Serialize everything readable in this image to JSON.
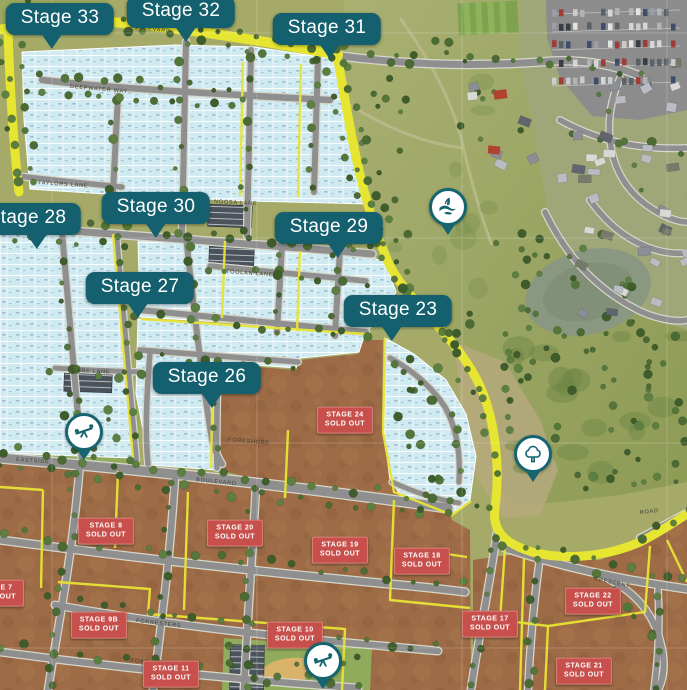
{
  "map": {
    "callouts": [
      {
        "label": "Stage 33"
      },
      {
        "label": "Stage 32"
      },
      {
        "label": "Stage 31"
      },
      {
        "label": "Stage 28"
      },
      {
        "label": "Stage 30"
      },
      {
        "label": "Stage 29"
      },
      {
        "label": "Stage 27"
      },
      {
        "label": "Stage 23"
      },
      {
        "label": "Stage 26"
      }
    ],
    "sold_badges": [
      {
        "name": "STAGE 24",
        "status": "SOLD OUT"
      },
      {
        "name": "STAGE 8",
        "status": "SOLD OUT"
      },
      {
        "name": "STAGE 20",
        "status": "SOLD OUT"
      },
      {
        "name": "STAGE 19",
        "status": "SOLD OUT"
      },
      {
        "name": "STAGE 18",
        "status": "SOLD OUT"
      },
      {
        "name": "STAGE 7",
        "status": "SOLD OUT"
      },
      {
        "name": "STAGE 9B",
        "status": "SOLD OUT"
      },
      {
        "name": "STAGE 10",
        "status": "SOLD OUT"
      },
      {
        "name": "STAGE 11",
        "status": "SOLD OUT"
      },
      {
        "name": "STAGE 17",
        "status": "SOLD OUT"
      },
      {
        "name": "STAGE 22",
        "status": "SOLD OUT"
      },
      {
        "name": "STAGE 21",
        "status": "SOLD OUT"
      }
    ],
    "pins": [
      {
        "icon": "wetland-icon"
      },
      {
        "icon": "playground-icon"
      },
      {
        "icon": "tree-icon"
      },
      {
        "icon": "playground-icon"
      }
    ],
    "streets": [
      "BOULEVARD",
      "DEEPWATER WAY",
      "TAYLORS LANE",
      "NOOSA LANE",
      "TOOLAN LANE",
      "DARE LANE",
      "EASTSIDE",
      "BOULEVARD",
      "FORESHORE",
      "FORRESTERS",
      "ROAD",
      "CRESCENT",
      "ROAD"
    ],
    "colors": {
      "callout_teal": "#15606e",
      "sold_red": "#c7504c",
      "available_blue": "#cfeaf1",
      "sold_brown": "#9d6b46",
      "boundary_yellow": "#e6e531"
    }
  }
}
